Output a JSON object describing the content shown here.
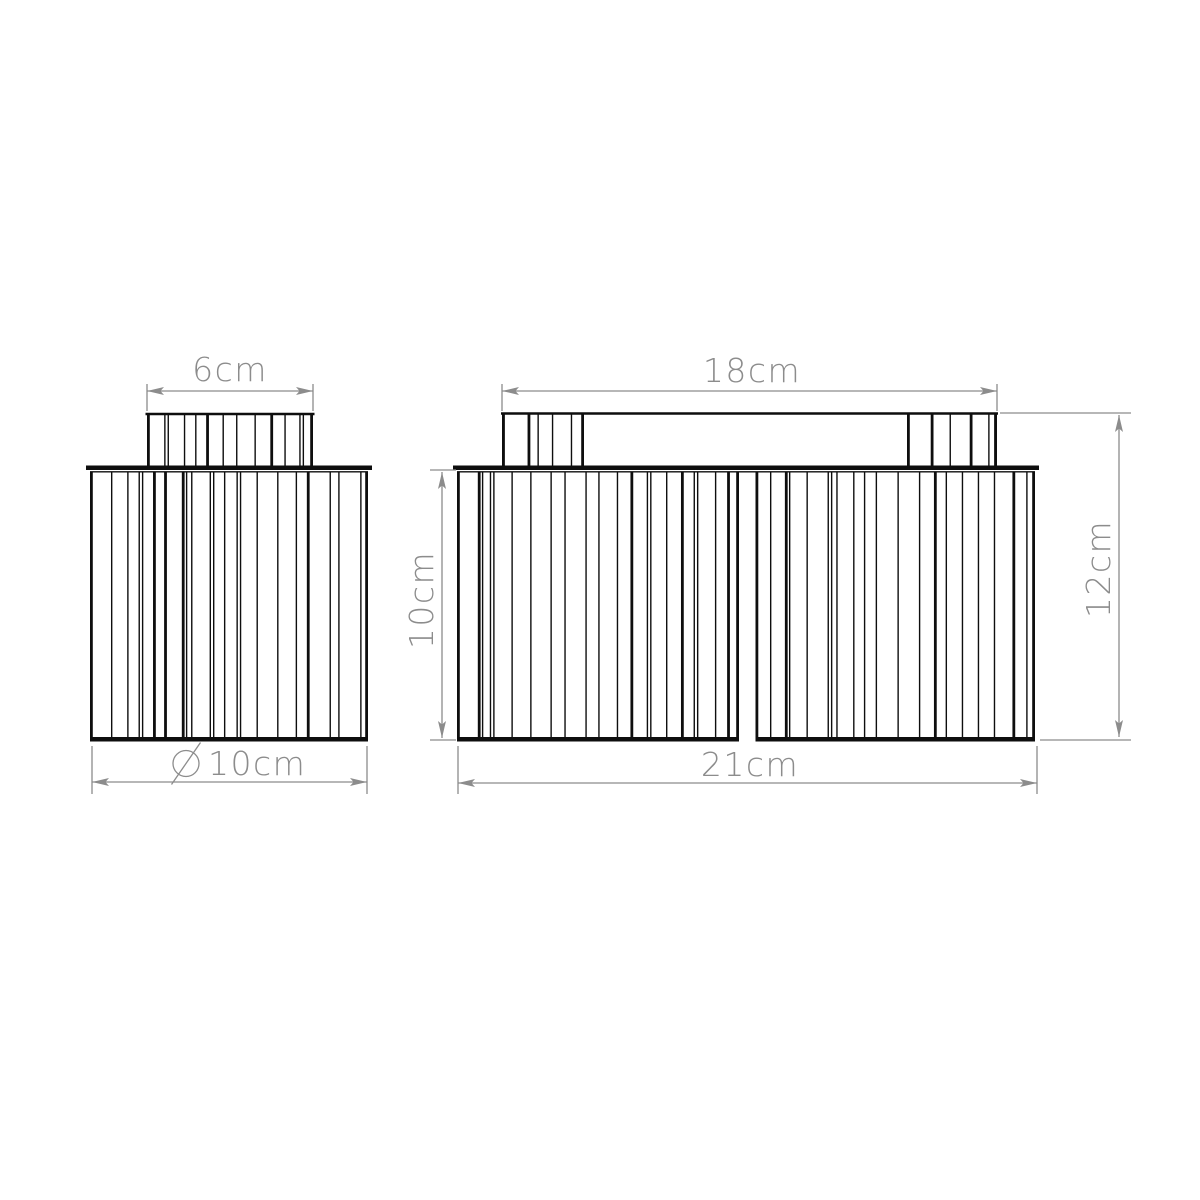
{
  "drawing": {
    "kind": "technical dimension drawing",
    "subject": "ribbed glass flush ceiling light, two orthographic views",
    "background": "#ffffff",
    "outline_color": "#0e0e0e",
    "dimension_color": "#8c8c8c"
  },
  "views": {
    "single_shade": {
      "name": "single shade side view",
      "cap_width_label": "6cm",
      "diameter_symbol": "⌀",
      "diameter_label": "10cm"
    },
    "twin_fixture": {
      "name": "twin fixture front view",
      "canopy_width_label": "18cm",
      "shade_height_label": "10cm",
      "overall_height_label": "12cm",
      "overall_width_label": "21cm"
    }
  }
}
